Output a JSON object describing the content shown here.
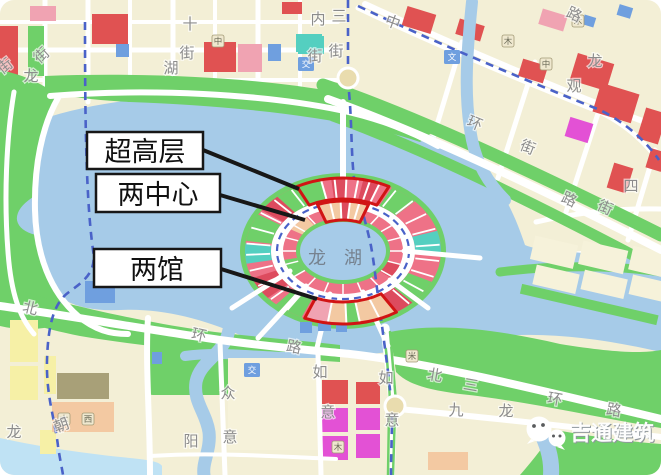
{
  "callouts": [
    {
      "label": "超高层"
    },
    {
      "label": "两中心"
    },
    {
      "label": "两馆"
    }
  ],
  "lake": {
    "name": "龙湖"
  },
  "watermark": {
    "text": "吉通建筑",
    "icon": "wechat-icon"
  },
  "street_labels": [
    {
      "t": "街",
      "x": 8,
      "y": 70,
      "r": -38
    },
    {
      "t": "龙",
      "x": 31,
      "y": 81,
      "r": 0
    },
    {
      "t": "街",
      "x": 45,
      "y": 59,
      "r": -42
    },
    {
      "t": "十",
      "x": 190,
      "y": 29,
      "r": 0
    },
    {
      "t": "街",
      "x": 187,
      "y": 58,
      "r": 0
    },
    {
      "t": "湖",
      "x": 171,
      "y": 73,
      "r": 0
    },
    {
      "t": "内",
      "x": 318,
      "y": 24,
      "r": 0
    },
    {
      "t": "街",
      "x": 315,
      "y": 61,
      "r": 0
    },
    {
      "t": "中",
      "x": 391,
      "y": 27,
      "r": 20
    },
    {
      "t": "三",
      "x": 339,
      "y": 21,
      "r": 0
    },
    {
      "t": "街",
      "x": 336,
      "y": 56,
      "r": 0
    },
    {
      "t": "路",
      "x": 572,
      "y": 19,
      "r": 25
    },
    {
      "t": "龙",
      "x": 595,
      "y": 66,
      "r": 0
    },
    {
      "t": "观",
      "x": 574,
      "y": 91,
      "r": 0
    },
    {
      "t": "环",
      "x": 473,
      "y": 128,
      "r": 22
    },
    {
      "t": "街",
      "x": 526,
      "y": 152,
      "r": 22
    },
    {
      "t": "四",
      "x": 631,
      "y": 191,
      "r": 0
    },
    {
      "t": "路",
      "x": 567,
      "y": 204,
      "r": 25
    },
    {
      "t": "街",
      "x": 603,
      "y": 212,
      "r": 25
    },
    {
      "t": "北",
      "x": 29,
      "y": 313,
      "r": 14
    },
    {
      "t": "环",
      "x": 198,
      "y": 340,
      "r": 12
    },
    {
      "t": "路",
      "x": 293,
      "y": 352,
      "r": 12
    },
    {
      "t": "朝",
      "x": 63,
      "y": 430,
      "r": -20
    },
    {
      "t": "龙",
      "x": 14,
      "y": 437,
      "r": 0
    },
    {
      "t": "众",
      "x": 228,
      "y": 398,
      "r": 0
    },
    {
      "t": "意",
      "x": 230,
      "y": 442,
      "r": 0
    },
    {
      "t": "阳",
      "x": 191,
      "y": 446,
      "r": 0
    },
    {
      "t": "如",
      "x": 320,
      "y": 377,
      "r": 0
    },
    {
      "t": "意",
      "x": 328,
      "y": 417,
      "r": 0
    },
    {
      "t": "北",
      "x": 434,
      "y": 380,
      "r": 10
    },
    {
      "t": "三",
      "x": 470,
      "y": 390,
      "r": 10
    },
    {
      "t": "环",
      "x": 554,
      "y": 404,
      "r": 10
    },
    {
      "t": "路",
      "x": 613,
      "y": 415,
      "r": 10
    },
    {
      "t": "九",
      "x": 456,
      "y": 415,
      "r": 0
    },
    {
      "t": "龙",
      "x": 506,
      "y": 416,
      "r": 0
    },
    {
      "t": "如",
      "x": 386,
      "y": 383,
      "r": 0
    },
    {
      "t": "意",
      "x": 392,
      "y": 425,
      "r": 0
    }
  ],
  "poi_labels": [
    {
      "t": "中",
      "x": 218,
      "y": 41
    },
    {
      "t": "木",
      "x": 508,
      "y": 41
    },
    {
      "t": "中",
      "x": 546,
      "y": 64
    },
    {
      "t": "木",
      "x": 578,
      "y": 21
    },
    {
      "t": "木",
      "x": 64,
      "y": 419
    },
    {
      "t": "西",
      "x": 88,
      "y": 419
    },
    {
      "t": "木",
      "x": 338,
      "y": 447
    },
    {
      "t": "米",
      "x": 412,
      "y": 356
    }
  ],
  "poi_blue_labels": [
    {
      "t": "交",
      "x": 306,
      "y": 64
    },
    {
      "t": "文",
      "x": 452,
      "y": 57
    },
    {
      "t": "交",
      "x": 252,
      "y": 370
    }
  ],
  "colors": {
    "cream": "#f3efd6",
    "creamBlock": "#f6f2da",
    "yellow": "#f6f0a6",
    "green": "#6fd069",
    "lake": "#a6cbe8",
    "lakeLight": "#bfe2f4",
    "road": "#ffffff",
    "red": "#e05252",
    "red2": "#dd4b5e",
    "pink": "#f0a3b2",
    "ringPink": "#ee7287",
    "peach": "#f3c9a2",
    "magenta": "#e351d5",
    "blue": "#6f9fdf",
    "teal": "#54cfc0",
    "olive": "#a8a078",
    "metro": "#4a62c8",
    "highlight": "#d11414",
    "label": "#8c8c8c",
    "lakeName": "#76828f"
  }
}
